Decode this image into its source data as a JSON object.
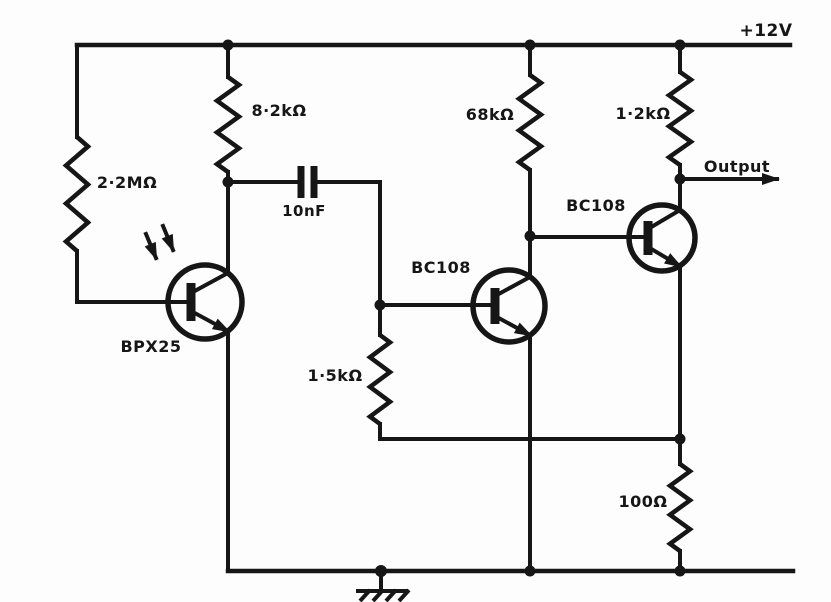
{
  "schematic": {
    "kind": "circuit-schematic",
    "supply_label": "+12V",
    "output_label": "Output",
    "ink_color": "#161616",
    "paper_color": "#fdfdfd",
    "components": {
      "r1": {
        "type": "resistor",
        "value": "2·2MΩ"
      },
      "r2": {
        "type": "resistor",
        "value": "8·2kΩ"
      },
      "r3": {
        "type": "resistor",
        "value": "68kΩ"
      },
      "r4": {
        "type": "resistor",
        "value": "1·2kΩ"
      },
      "r5": {
        "type": "resistor",
        "value": "1·5kΩ"
      },
      "r6": {
        "type": "resistor",
        "value": "100Ω"
      },
      "c1": {
        "type": "capacitor",
        "value": "10nF"
      },
      "q1": {
        "type": "phototransistor",
        "part": "BPX25"
      },
      "q2": {
        "type": "npn-transistor",
        "part": "BC108"
      },
      "q3": {
        "type": "npn-transistor",
        "part": "BC108"
      }
    }
  }
}
